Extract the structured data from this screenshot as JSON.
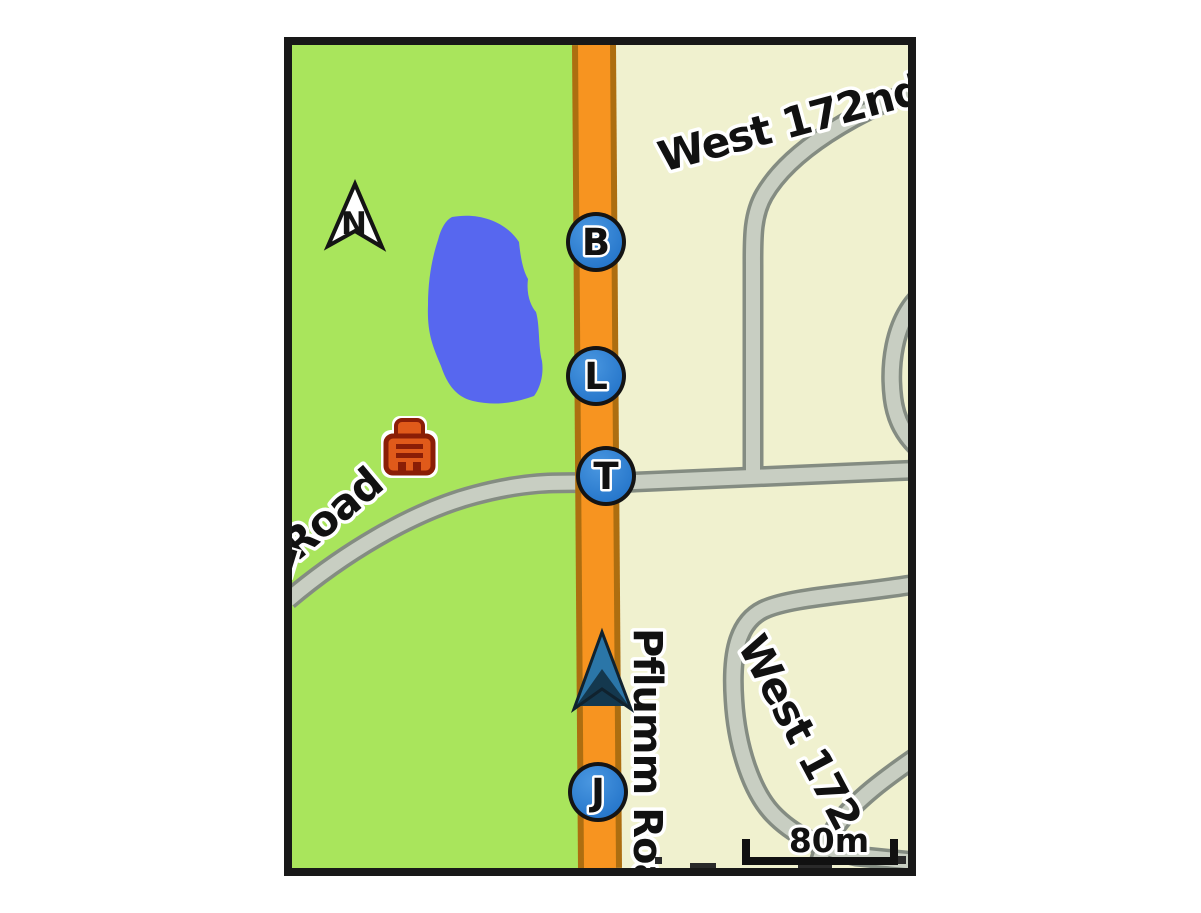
{
  "device_map": {
    "compass": {
      "letter": "N"
    },
    "labels": {
      "west_172nd": "West 172nd",
      "pflumm_road": "Pflumm Road",
      "loop_road": "West 172",
      "cross_road": "Road"
    },
    "waypoints": [
      {
        "letter": "B"
      },
      {
        "letter": "L"
      },
      {
        "letter": "T"
      },
      {
        "letter": "J"
      }
    ],
    "scale_bar": {
      "label": "80m"
    },
    "colors": {
      "land_west_green": "#a9e55c",
      "land_east_cream": "#f0f1cf",
      "water_blue": "#5767ef",
      "highway_fill": "#f79420",
      "highway_casing": "#ad6e10",
      "road_fill": "#c8cec2",
      "road_casing": "#848c82",
      "waypoint_blue": "#2b7fd6",
      "position_arrow_light": "#2b76a8",
      "position_arrow_dark": "#14384e",
      "poi_building_orange": "#e05a1a",
      "poi_building_outline": "#8a1e06",
      "frame_black": "#181818"
    }
  }
}
